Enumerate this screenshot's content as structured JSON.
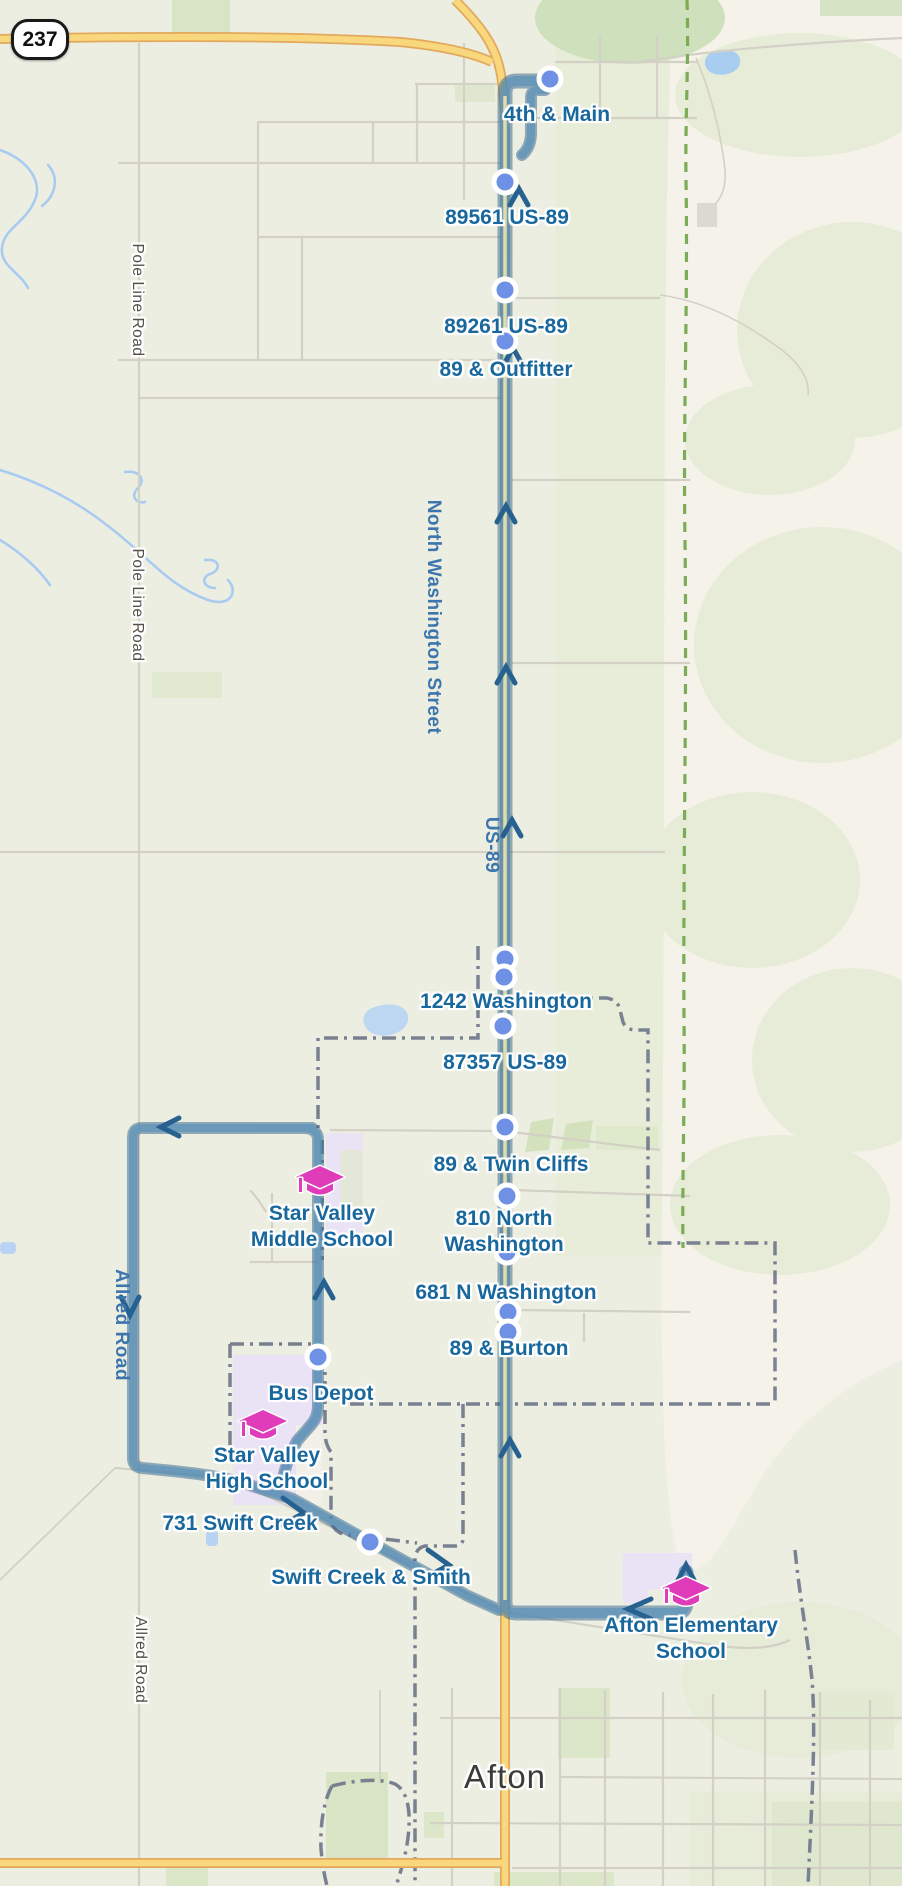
{
  "map_type": "transit-route-map",
  "town": {
    "label": "Afton"
  },
  "highway_shield": {
    "label": "237"
  },
  "stops": [
    {
      "label": "4th & Main"
    },
    {
      "label": "89561 US-89"
    },
    {
      "label": "89261 US-89"
    },
    {
      "label": "89 & Outfitter"
    },
    {
      "label": "1242 Washington"
    },
    {
      "label": "87357 US-89"
    },
    {
      "label": "89 & Twin Cliffs"
    },
    {
      "label": "810 North\nWashington"
    },
    {
      "label": "681 N Washington"
    },
    {
      "label": "89 & Burton"
    },
    {
      "label": "Bus Depot"
    },
    {
      "label": "731 Swift Creek"
    },
    {
      "label": "Swift Creek & Smith"
    }
  ],
  "schools": [
    {
      "label": "Star Valley\nMiddle School",
      "icon": "graduation-cap-icon"
    },
    {
      "label": "Star Valley\nHigh School",
      "icon": "graduation-cap-icon"
    },
    {
      "label": "Afton Elementary\nSchool",
      "icon": "graduation-cap-icon"
    }
  ],
  "road_labels": [
    {
      "label": "Pole Line Road"
    },
    {
      "label": "Pole Line Road"
    },
    {
      "label": "North Washington Street"
    },
    {
      "label": "US-89"
    },
    {
      "label": "Allred Road"
    },
    {
      "label": "Allred Road"
    }
  ],
  "icons": {
    "stop_marker": "circle-marker",
    "direction_arrow": "chevron-arrow",
    "school": "graduation-cap-icon"
  },
  "colors": {
    "route_blue": "#5d93bc",
    "route_casing": "#2f6288",
    "stop_marker_fill": "#6e90e5",
    "stop_label_blue": "#19689d",
    "school_pink": "#e03cba",
    "highway_yellow": "#f9d87d",
    "boundary_slate": "#6d7689",
    "trail_green": "#7cac55",
    "campus_lavender": "#eae2f5",
    "map_background": "#edeee2"
  }
}
